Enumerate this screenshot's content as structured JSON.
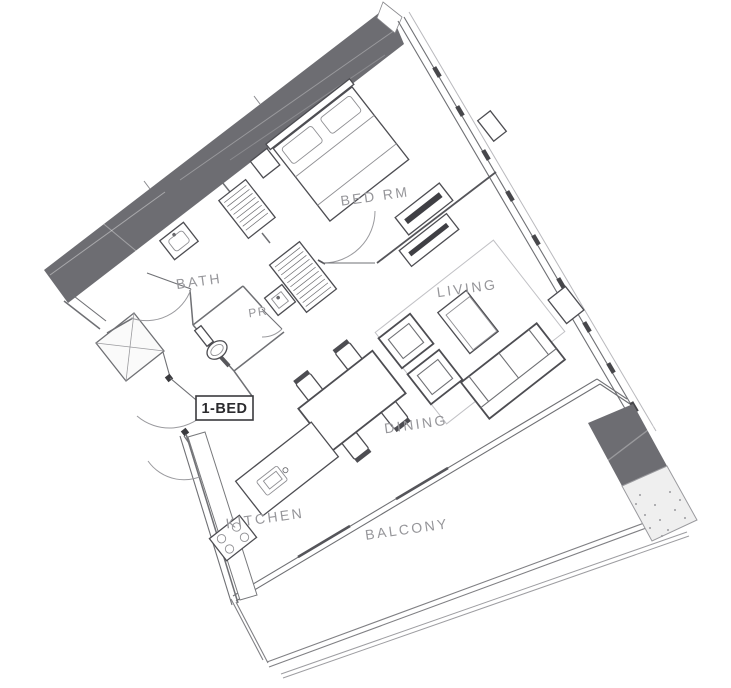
{
  "plan": {
    "unit_label": "1-BED",
    "rooms": [
      {
        "id": "bedroom",
        "label": "BED RM"
      },
      {
        "id": "bath",
        "label": "BATH"
      },
      {
        "id": "powder-room",
        "label": "PR"
      },
      {
        "id": "living",
        "label": "LIVING"
      },
      {
        "id": "dining",
        "label": "DINING"
      },
      {
        "id": "kitchen",
        "label": "KITCHEN"
      },
      {
        "id": "balcony",
        "label": "BALCONY"
      }
    ],
    "colors": {
      "background": "#ffffff",
      "wall_fill": "#6d6d72",
      "line": "#6f7074",
      "furniture_line": "#4d4d52",
      "label_text": "#96969a",
      "unit_label_text": "#2b2b2e"
    }
  }
}
